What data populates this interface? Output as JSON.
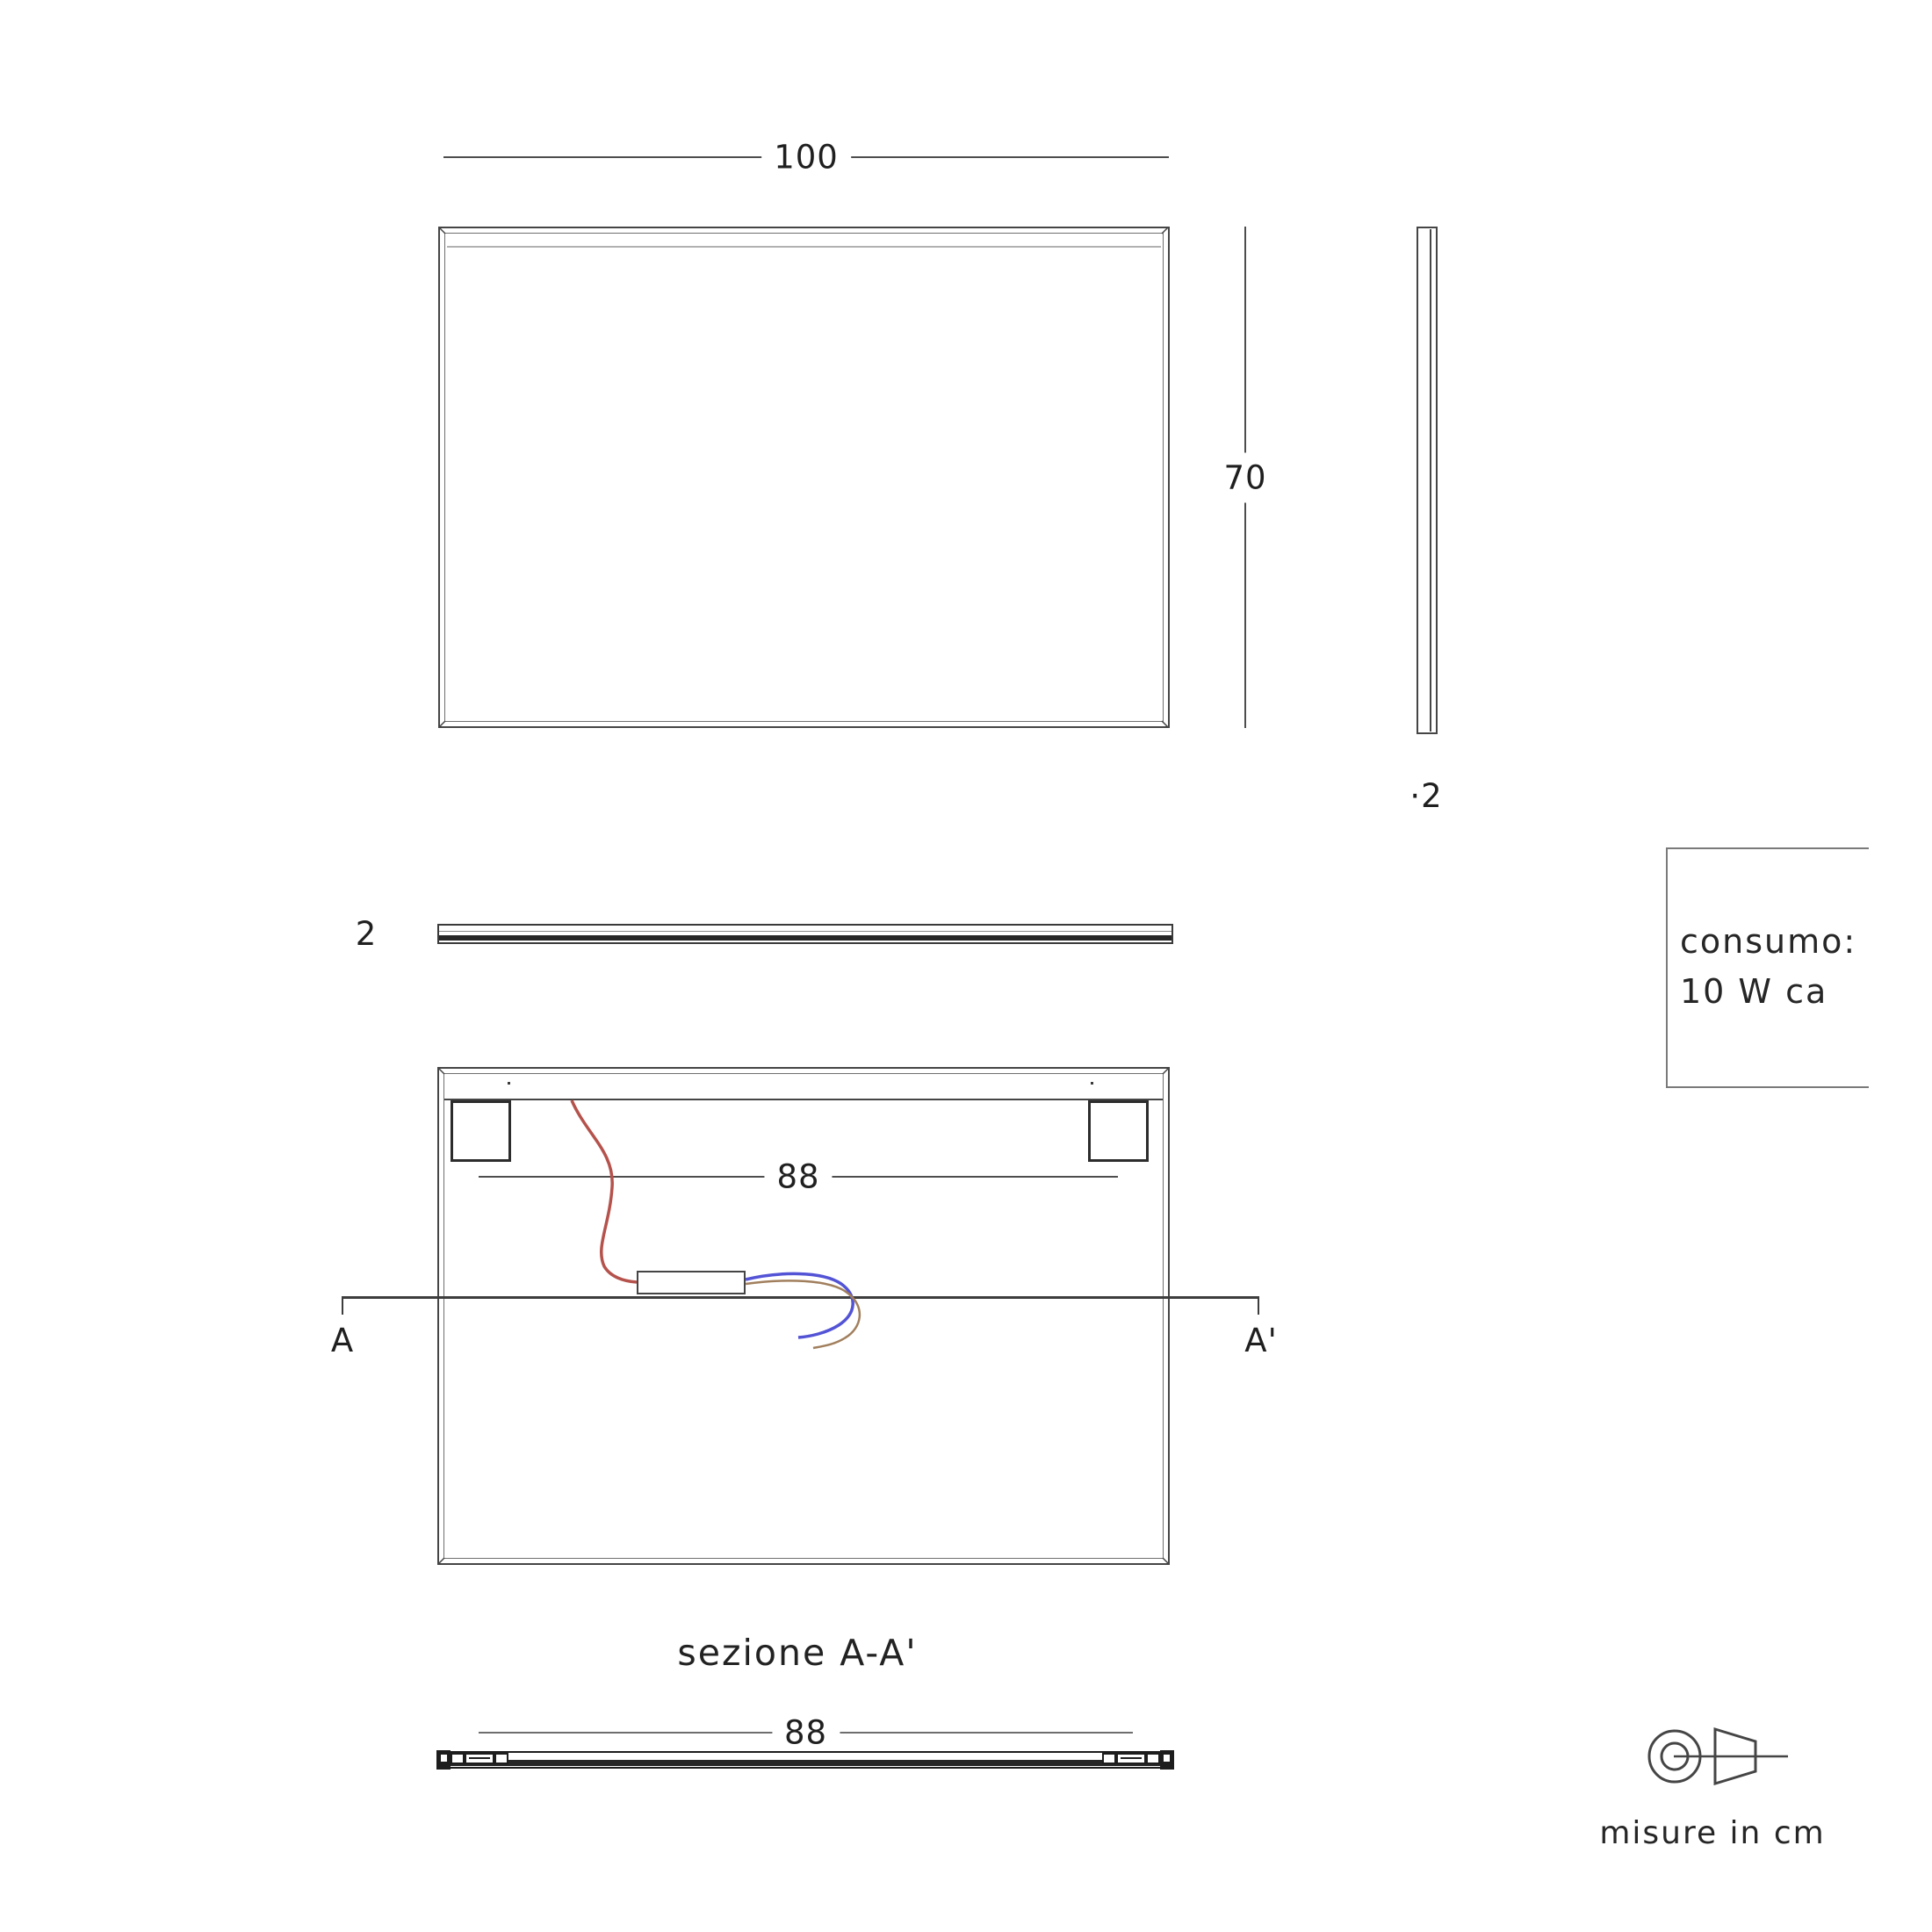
{
  "drawing": {
    "title": "mirror technical drawing",
    "units_note": "misure in cm"
  },
  "views": {
    "front": {
      "width_label": "100",
      "height_label": "70"
    },
    "side": {
      "thickness_label": "·2"
    },
    "top": {
      "thickness_label": "2"
    },
    "back": {
      "inner_width_label": "88",
      "section_letter_left": "A",
      "section_letter_right": "A'"
    },
    "section": {
      "caption": "sezione A-A'",
      "width_label": "88"
    }
  },
  "info_box": {
    "line1": "consumo:",
    "line2": "10 W ca"
  },
  "footer": {
    "note": "misure in cm"
  },
  "icon": {
    "name": "first-angle-projection"
  },
  "colors": {
    "line": "#454545",
    "dim_line": "#4d4d4d",
    "wire_red": "#b5524c",
    "wire_blue": "#5353d6",
    "wire_brown": "#a17f5d",
    "led_strip": "#b1b1b1"
  }
}
